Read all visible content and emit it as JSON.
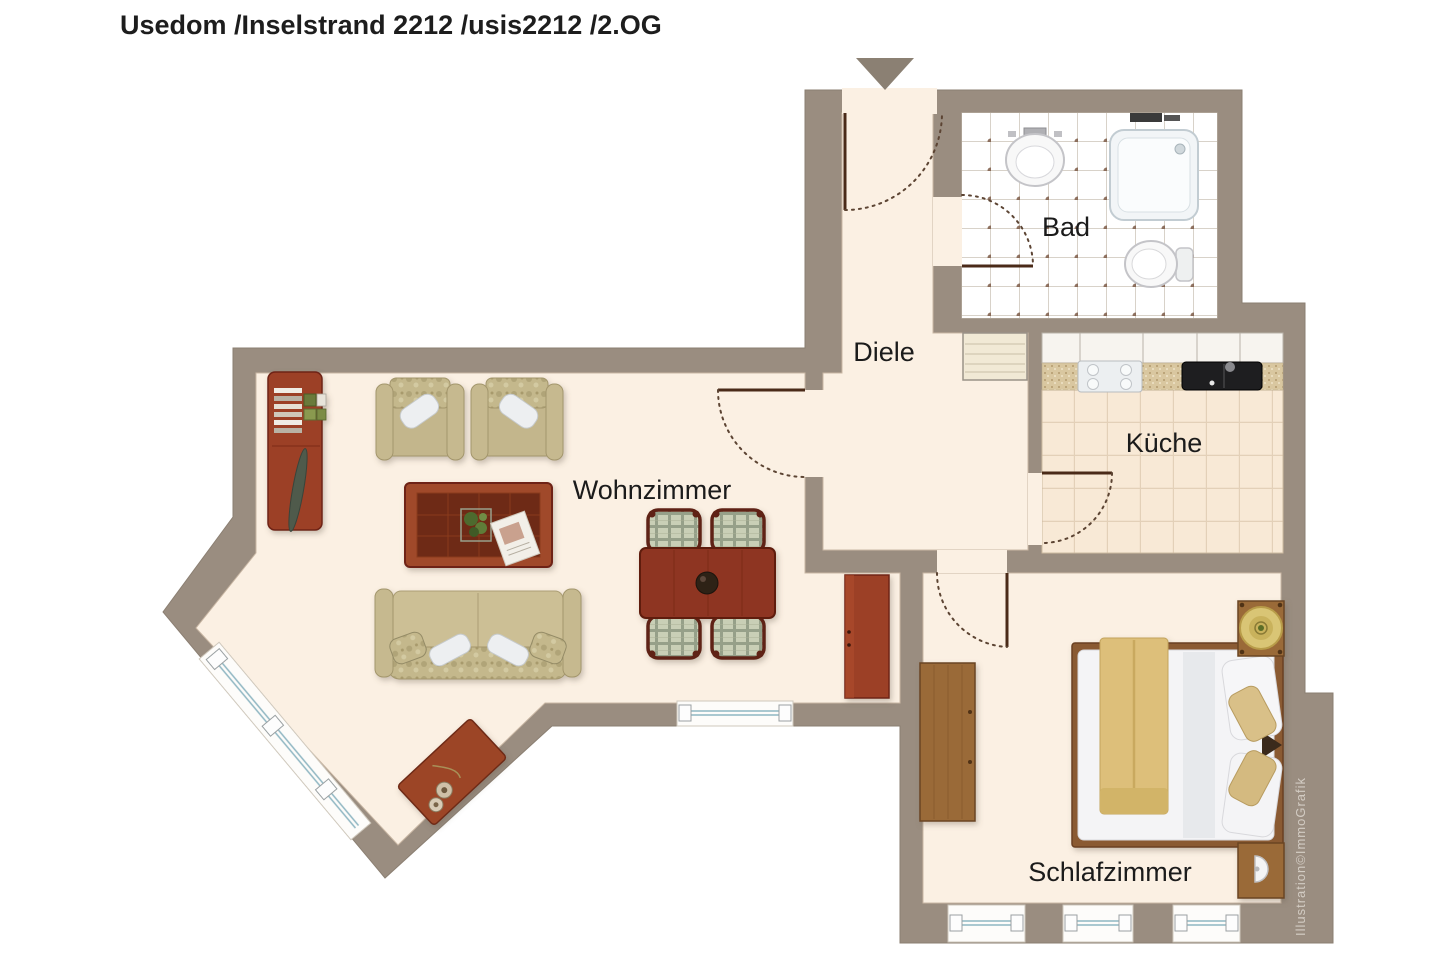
{
  "title": "Usedom /Inselstrand 2212 /usis2212 /2.OG",
  "rooms": {
    "bad": "Bad",
    "diele": "Diele",
    "kueche": "Küche",
    "wohnzimmer": "Wohnzimmer",
    "schlafzimmer": "Schlafzimmer"
  },
  "watermark": "Illustration©ImmoGrafik",
  "icons": {
    "entrance": "down-arrow"
  },
  "colors": {
    "pageBg": "#ffffff",
    "wall": "#9a8d80",
    "floor": "#fbf0e3",
    "bathFloor": "#ffffff",
    "kitchenFloor": "#f8e9d6",
    "woodDark": "#9c4026",
    "woodLight": "#9a6b39",
    "windowLine": "#8fb6c2",
    "door": "#4a2a18",
    "arrow": "#8b8073"
  }
}
